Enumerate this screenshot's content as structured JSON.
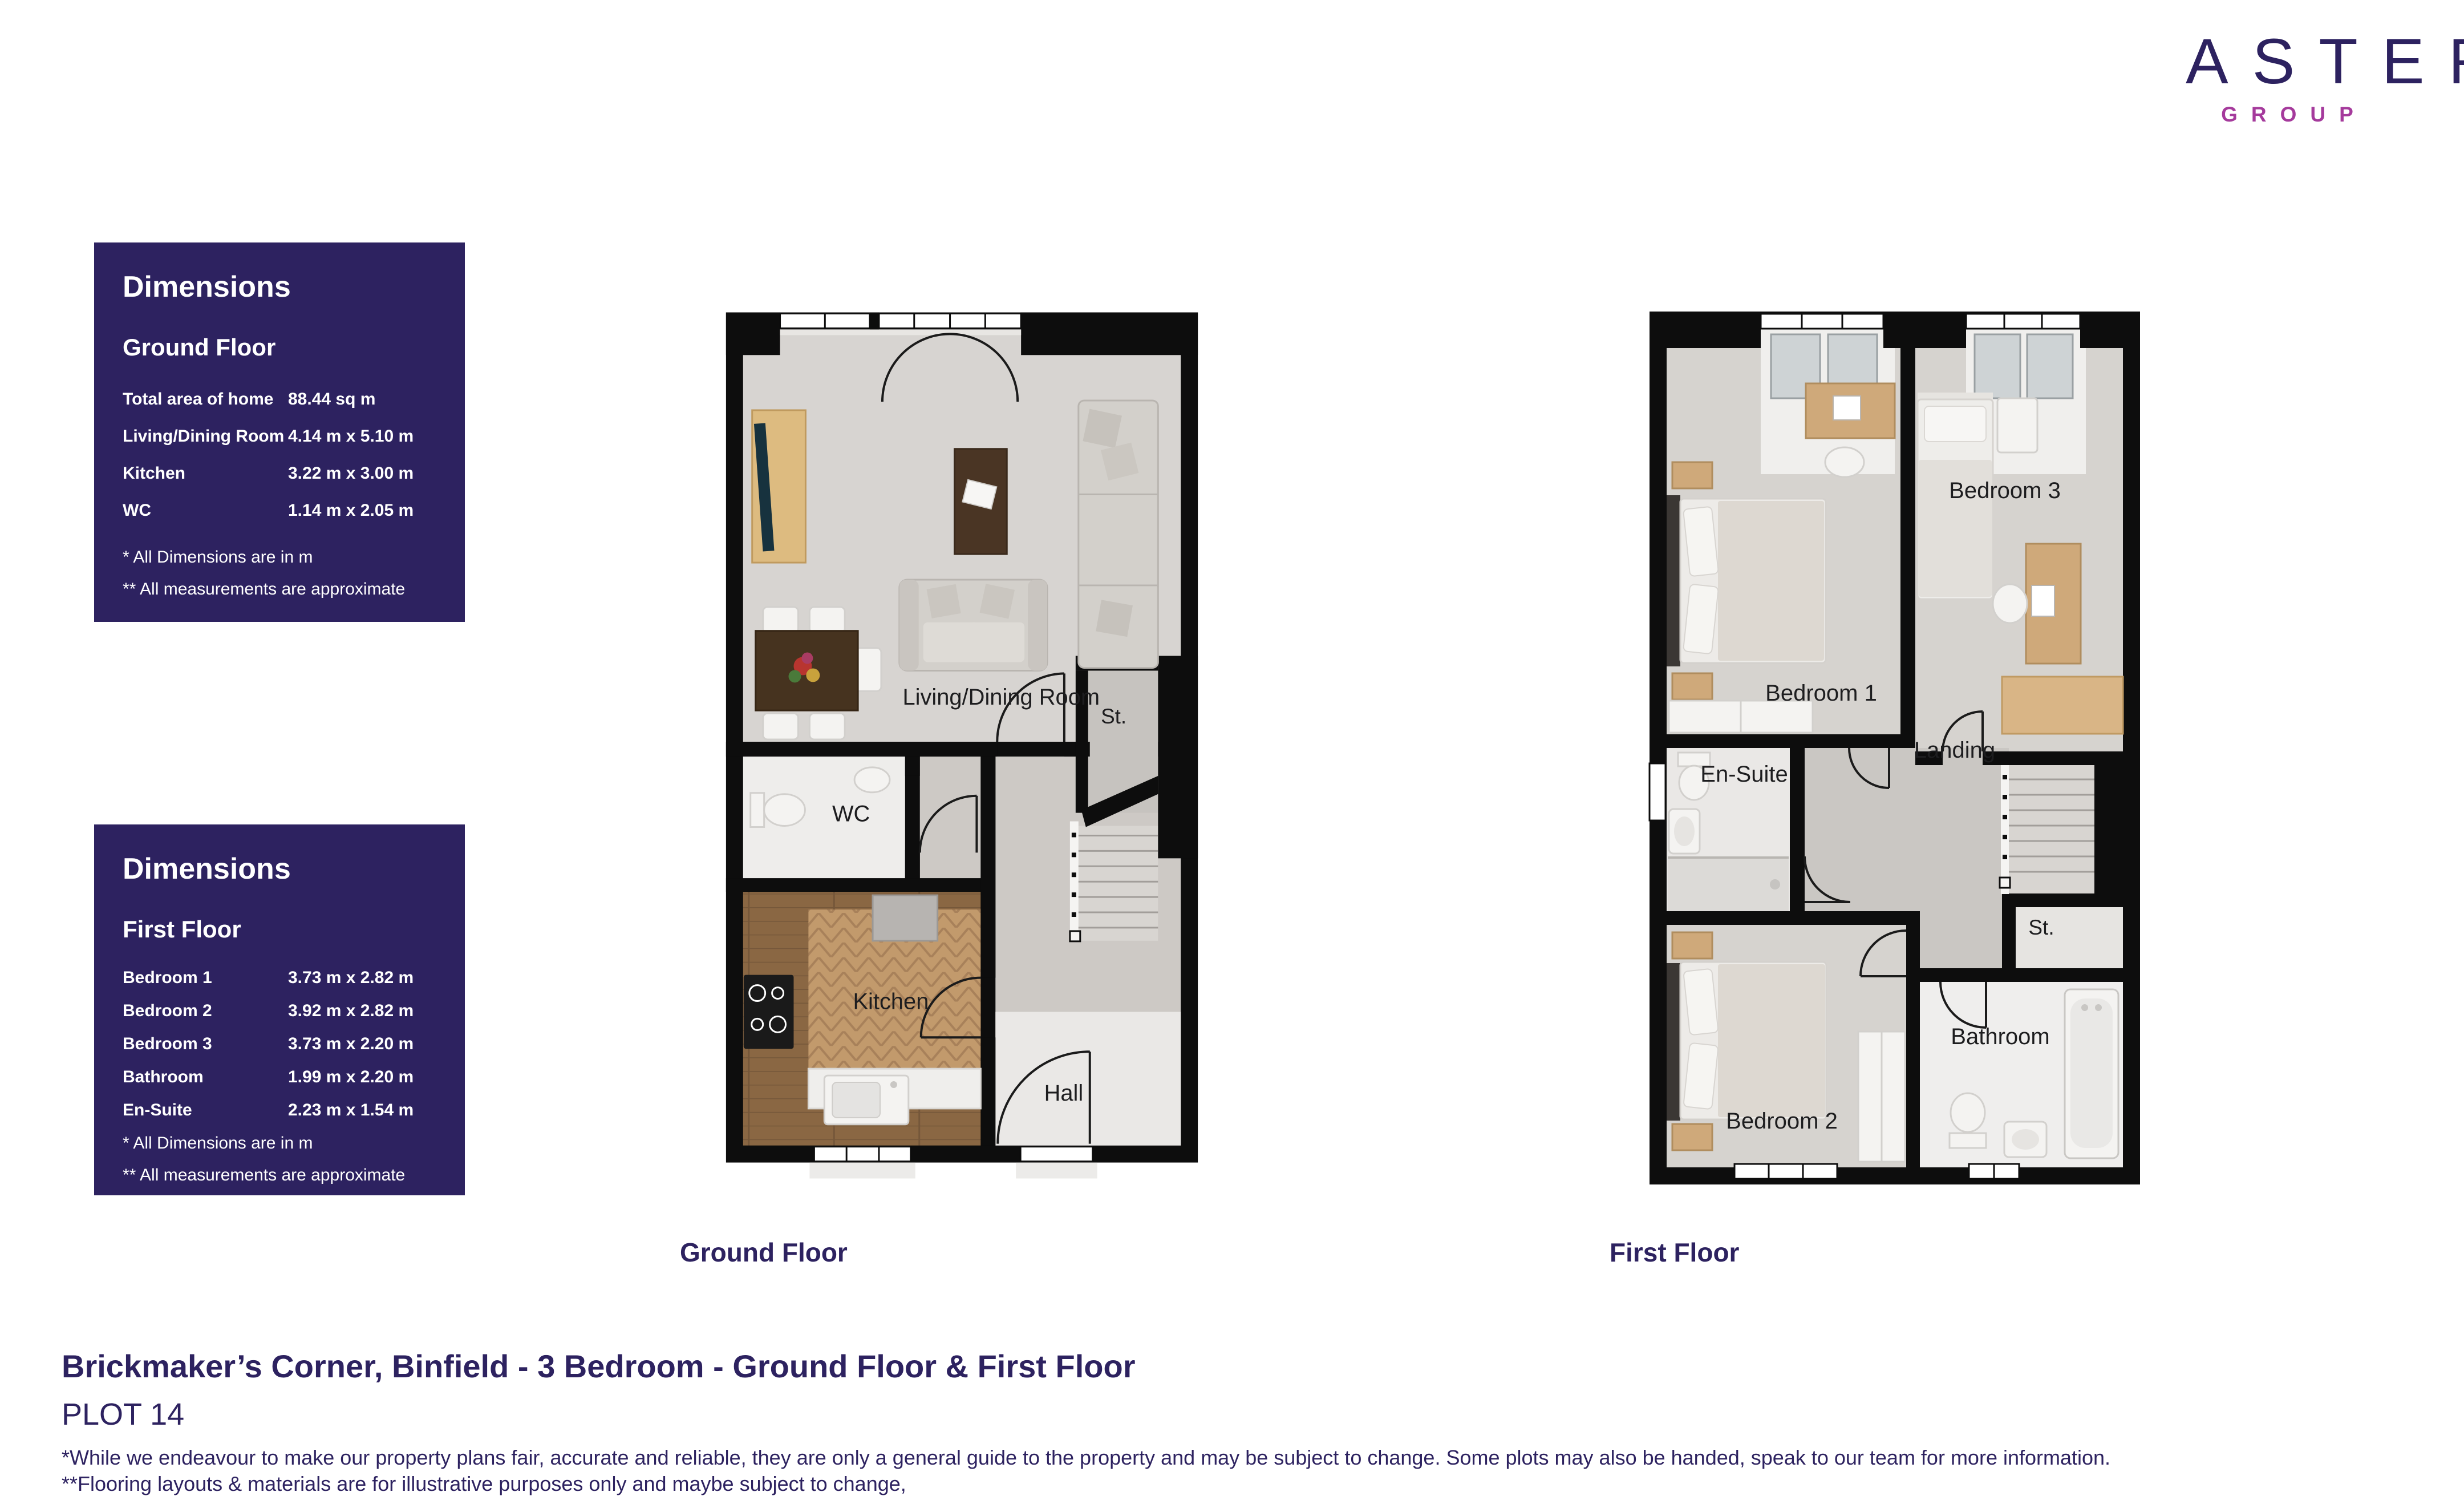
{
  "brand": {
    "name": "ASTER",
    "subtitle": "GROUP",
    "navy": "#2d2260",
    "magenta": "#a53a9c"
  },
  "panels": [
    {
      "title": "Dimensions",
      "floor": "Ground Floor",
      "rows": [
        {
          "label": "Total area of home",
          "value": "88.44 sq m"
        },
        {
          "label": "Living/Dining Room",
          "value": "4.14 m x 5.10 m"
        },
        {
          "label": "Kitchen",
          "value": "3.22 m x 3.00 m"
        },
        {
          "label": "WC",
          "value": "1.14 m x 2.05 m"
        }
      ],
      "footnotes": [
        "* All Dimensions are in m",
        "** All measurements are approximate"
      ]
    },
    {
      "title": "Dimensions",
      "floor": "First Floor",
      "rows": [
        {
          "label": "Bedroom 1",
          "value": "3.73 m x 2.82 m"
        },
        {
          "label": "Bedroom 2",
          "value": "3.92 m x 2.82 m"
        },
        {
          "label": "Bedroom 3",
          "value": "3.73 m x 2.20 m"
        },
        {
          "label": "Bathroom",
          "value": "1.99 m x 2.20 m"
        },
        {
          "label": "En-Suite",
          "value": "2.23 m x 1.54 m"
        }
      ],
      "footnotes": [
        "* All Dimensions are in m",
        "** All measurements are approximate"
      ]
    }
  ],
  "plans": {
    "ground": {
      "caption": "Ground Floor",
      "labels": {
        "living": "Living/Dining Room",
        "st": "St.",
        "wc": "WC",
        "kitchen": "Kitchen",
        "hall": "Hall"
      }
    },
    "first": {
      "caption": "First Floor",
      "labels": {
        "bedroom1": "Bedroom 1",
        "bedroom3": "Bedroom 3",
        "landing": "Landing",
        "ensuite": "En-Suite",
        "st": "St.",
        "bathroom": "Bathroom",
        "bedroom2": "Bedroom 2"
      }
    }
  },
  "footer": {
    "title": "Brickmaker’s Corner, Binfield - 3 Bedroom  - Ground Floor & First Floor",
    "plot": "PLOT 14",
    "disclaimers": [
      "*While we endeavour to make our property plans fair, accurate and reliable, they are only a general guide to the property and may be subject to change. Some plots may also be handed, speak to our team for more information.",
      "**Flooring layouts & materials are for illustrative purposes only and maybe subject to change,"
    ]
  }
}
